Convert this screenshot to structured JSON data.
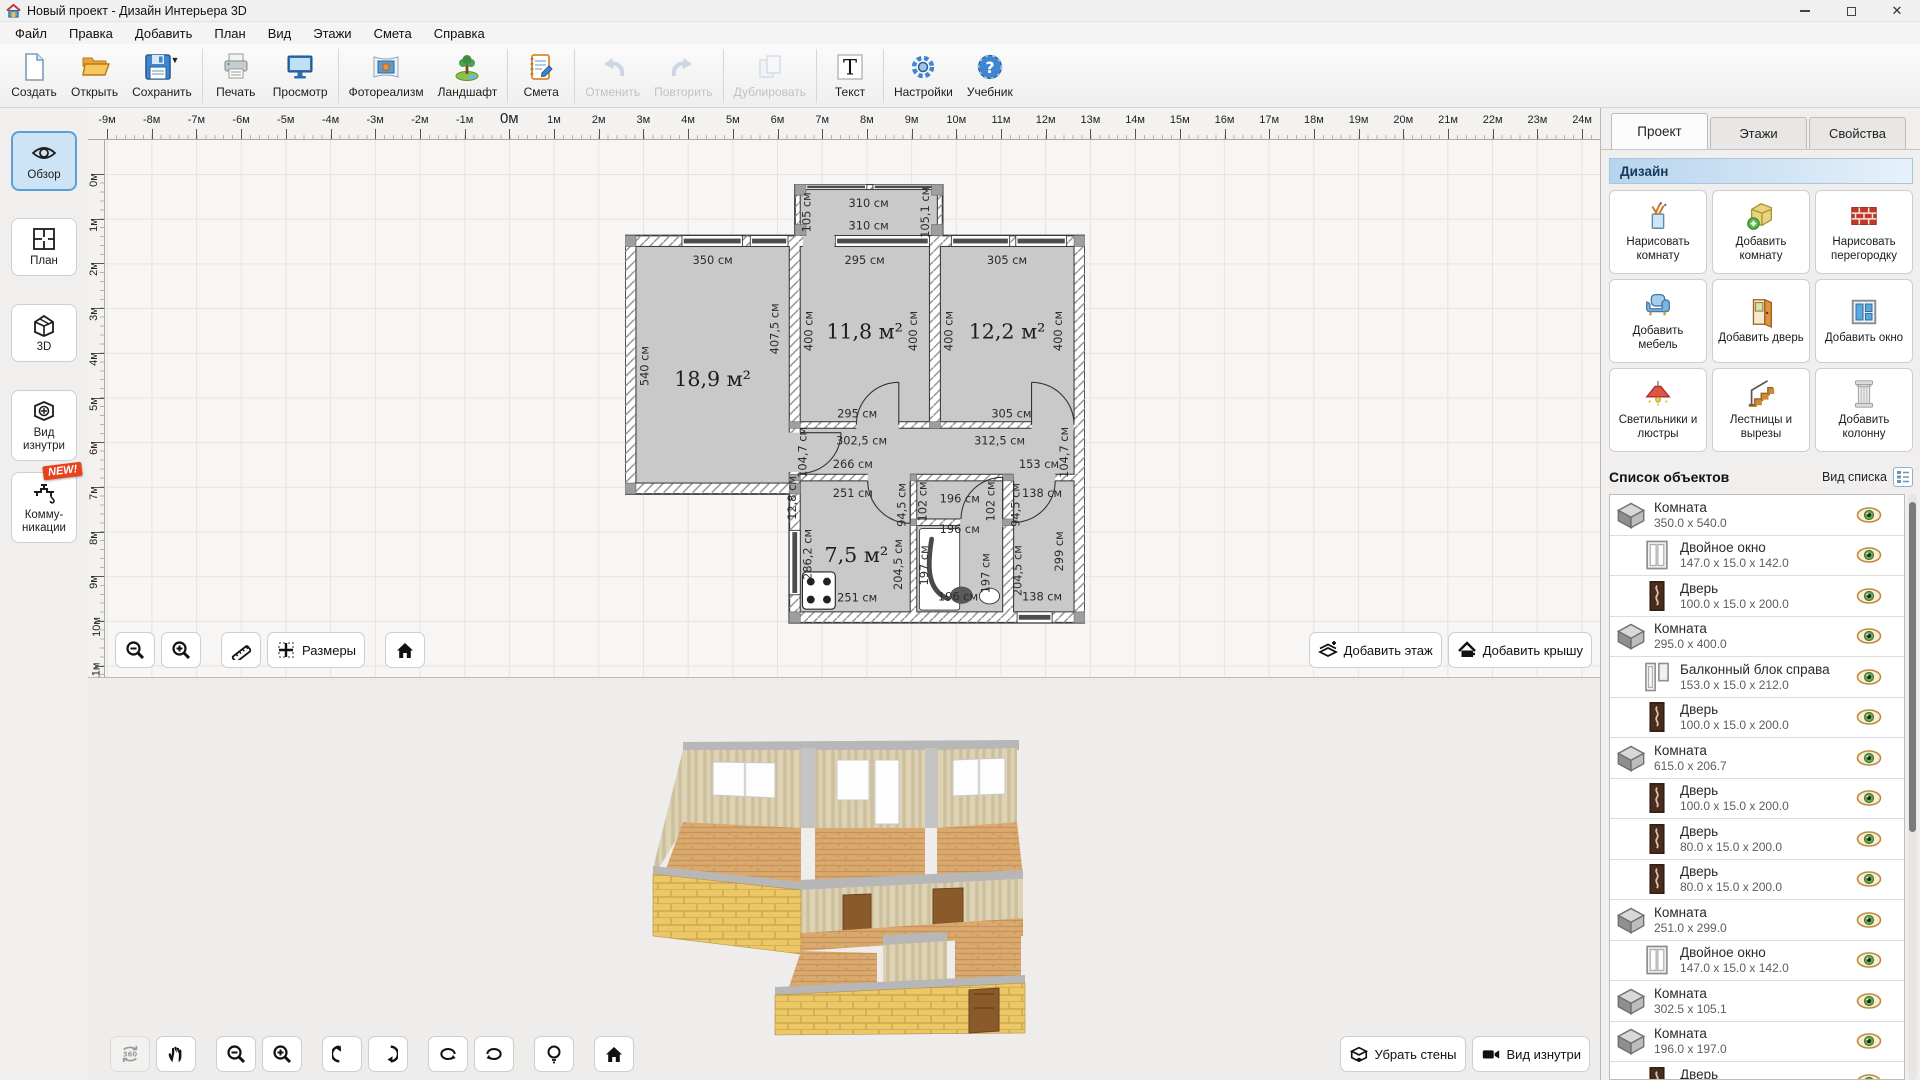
{
  "window": {
    "title": "Новый проект - Дизайн Интерьера 3D"
  },
  "menu": [
    "Файл",
    "Правка",
    "Добавить",
    "План",
    "Вид",
    "Этажи",
    "Смета",
    "Справка"
  ],
  "toolbar": {
    "items": [
      {
        "label": "Создать"
      },
      {
        "label": "Открыть"
      },
      {
        "label": "Сохранить"
      },
      {
        "label": "Печать"
      },
      {
        "label": "Просмотр"
      },
      {
        "label": "Фотореализм"
      },
      {
        "label": "Ландшафт"
      },
      {
        "label": "Смета"
      },
      {
        "label": "Отменить",
        "disabled": true
      },
      {
        "label": "Повторить",
        "disabled": true
      },
      {
        "label": "Дублировать",
        "disabled": true
      },
      {
        "label": "Текст"
      },
      {
        "label": "Настройки"
      },
      {
        "label": "Учебник"
      }
    ]
  },
  "sidebar": {
    "items": [
      {
        "label": "Обзор",
        "active": true
      },
      {
        "label": "План"
      },
      {
        "label": "3D"
      },
      {
        "label": "Вид изнутри"
      },
      {
        "label": "Комму- никации",
        "badge": "NEW!"
      }
    ]
  },
  "rulers": {
    "step": 44.7,
    "h_start": 19,
    "v_start": 34,
    "h": [
      "-9м",
      "-8м",
      "-7м",
      "-6м",
      "-5м",
      "-4м",
      "-3м",
      "-2м",
      "-1м",
      "0м",
      "1м",
      "2м",
      "3м",
      "4м",
      "5м",
      "6м",
      "7м",
      "8м",
      "9м",
      "10м",
      "11м",
      "12м",
      "13м",
      "14м",
      "15м",
      "16м",
      "17м",
      "18м",
      "19м",
      "20м",
      "21м",
      "22м",
      "23м",
      "24м"
    ],
    "h_zero_index": 9,
    "v": [
      "0м",
      "1м",
      "2м",
      "3м",
      "4м",
      "5м",
      "6м",
      "7м",
      "8м",
      "9м",
      "10м",
      "11м"
    ]
  },
  "plan": {
    "labels": [
      {
        "t": "310 см",
        "x": 556,
        "y": 52
      },
      {
        "t": "310 см",
        "x": 556,
        "y": 103
      },
      {
        "t": "105 см",
        "x": 424,
        "y": 64,
        "r": -90
      },
      {
        "t": "105,1 см",
        "x": 694,
        "y": 64,
        "r": -90
      },
      {
        "t": "350 см",
        "x": 200,
        "y": 182
      },
      {
        "t": "295 см",
        "x": 547,
        "y": 182
      },
      {
        "t": "305 см",
        "x": 872,
        "y": 182
      },
      {
        "t": "540 см",
        "x": 54,
        "y": 415,
        "r": -90
      },
      {
        "t": "407,5 см",
        "x": 350,
        "y": 330,
        "r": -90
      },
      {
        "t": "400 см",
        "x": 428,
        "y": 335,
        "r": -90
      },
      {
        "t": "400 см",
        "x": 667,
        "y": 335,
        "r": -90
      },
      {
        "t": "400 см",
        "x": 748,
        "y": 335,
        "r": -90
      },
      {
        "t": "400 см",
        "x": 997,
        "y": 335,
        "r": -90
      },
      {
        "t": "18,9 м²",
        "x": 200,
        "y": 460,
        "serif": true
      },
      {
        "t": "11,8 м²",
        "x": 547,
        "y": 352,
        "serif": true
      },
      {
        "t": "12,2 м²",
        "x": 872,
        "y": 352,
        "serif": true
      },
      {
        "t": "295 см",
        "x": 530,
        "y": 532
      },
      {
        "t": "305 см",
        "x": 882,
        "y": 532
      },
      {
        "t": "302,5 см",
        "x": 540,
        "y": 594
      },
      {
        "t": "312,5 см",
        "x": 855,
        "y": 594
      },
      {
        "t": "266 см",
        "x": 520,
        "y": 648
      },
      {
        "t": "153 см",
        "x": 945,
        "y": 648
      },
      {
        "t": "104,7 см",
        "x": 414,
        "y": 612,
        "r": -90,
        "s": 22
      },
      {
        "t": "104,7 см",
        "x": 1011,
        "y": 612,
        "r": -90,
        "s": 22
      },
      {
        "t": "12,8 см",
        "x": 390,
        "y": 716,
        "r": -90,
        "s": 20
      },
      {
        "t": "251 см",
        "x": 520,
        "y": 714
      },
      {
        "t": "138 см",
        "x": 952,
        "y": 714
      },
      {
        "t": "94,5 см",
        "x": 640,
        "y": 732,
        "r": -90,
        "s": 22
      },
      {
        "t": "94,5 см",
        "x": 900,
        "y": 732,
        "r": -90,
        "s": 22
      },
      {
        "t": "102 см",
        "x": 688,
        "y": 724,
        "r": -90,
        "s": 22
      },
      {
        "t": "102 см",
        "x": 843,
        "y": 724,
        "r": -90,
        "s": 22
      },
      {
        "t": "196 см",
        "x": 764,
        "y": 726
      },
      {
        "t": "196 см",
        "x": 764,
        "y": 796
      },
      {
        "t": "286,2 см",
        "x": 426,
        "y": 845,
        "r": -90
      },
      {
        "t": "204,5 см",
        "x": 632,
        "y": 868,
        "r": -90
      },
      {
        "t": "7,5 м²",
        "x": 528,
        "y": 862,
        "serif": true
      },
      {
        "t": "197 см",
        "x": 692,
        "y": 870,
        "r": -90,
        "s": 22
      },
      {
        "t": "197 см",
        "x": 832,
        "y": 888,
        "r": -90,
        "s": 22
      },
      {
        "t": "204,5 см",
        "x": 905,
        "y": 882,
        "r": -90
      },
      {
        "t": "299 см",
        "x": 1000,
        "y": 838,
        "r": -90
      },
      {
        "t": "251 см",
        "x": 530,
        "y": 952
      },
      {
        "t": "196 см",
        "x": 760,
        "y": 950
      },
      {
        "t": "138 см",
        "x": 952,
        "y": 950
      }
    ]
  },
  "plan_toolbar": {
    "sizes_label": "Размеры",
    "add_floor": "Добавить этаж",
    "add_roof": "Добавить крышу"
  },
  "view3d_toolbar": {
    "label_360": "360",
    "remove_walls": "Убрать стены",
    "view_inside": "Вид изнутри"
  },
  "right_panel": {
    "tabs": [
      {
        "label": "Проект",
        "active": true
      },
      {
        "label": "Этажи"
      },
      {
        "label": "Свойства"
      }
    ],
    "section_header": "Дизайн",
    "buttons": [
      {
        "label": "Нарисовать комнату"
      },
      {
        "label": "Добавить комнату"
      },
      {
        "label": "Нарисовать перегородку"
      },
      {
        "label": "Добавить мебель"
      },
      {
        "label": "Добавить дверь"
      },
      {
        "label": "Добавить окно"
      },
      {
        "label": "Светильники и люстры"
      },
      {
        "label": "Лестницы и вырезы"
      },
      {
        "label": "Добавить колонну"
      }
    ],
    "list_header": "Список объектов",
    "view_label": "Вид списка",
    "objects": [
      {
        "icon": "room",
        "name": "Комната",
        "dims": "350.0 x 540.0",
        "indent": 0
      },
      {
        "icon": "window",
        "name": "Двойное окно",
        "dims": "147.0 x 15.0 x 142.0",
        "indent": 1
      },
      {
        "icon": "door",
        "name": "Дверь",
        "dims": "100.0 x 15.0 x 200.0",
        "indent": 1
      },
      {
        "icon": "room",
        "name": "Комната",
        "dims": "295.0 x 400.0",
        "indent": 0
      },
      {
        "icon": "balcony",
        "name": "Балконный блок справа",
        "dims": "153.0 x 15.0 x 212.0",
        "indent": 1
      },
      {
        "icon": "door",
        "name": "Дверь",
        "dims": "100.0 x 15.0 x 200.0",
        "indent": 1
      },
      {
        "icon": "room",
        "name": "Комната",
        "dims": "615.0 x 206.7",
        "indent": 0
      },
      {
        "icon": "door",
        "name": "Дверь",
        "dims": "100.0 x 15.0 x 200.0",
        "indent": 1
      },
      {
        "icon": "door",
        "name": "Дверь",
        "dims": "80.0 x 15.0 x 200.0",
        "indent": 1
      },
      {
        "icon": "door",
        "name": "Дверь",
        "dims": "80.0 x 15.0 x 200.0",
        "indent": 1
      },
      {
        "icon": "room",
        "name": "Комната",
        "dims": "251.0 x 299.0",
        "indent": 0
      },
      {
        "icon": "window",
        "name": "Двойное окно",
        "dims": "147.0 x 15.0 x 142.0",
        "indent": 1
      },
      {
        "icon": "room",
        "name": "Комната",
        "dims": "302.5 x 105.1",
        "indent": 0
      },
      {
        "icon": "room",
        "name": "Комната",
        "dims": "196.0 x 197.0",
        "indent": 0
      },
      {
        "icon": "door",
        "name": "Дверь",
        "dims": "80.0 x 15.0 x 200.0",
        "indent": 1
      }
    ]
  }
}
